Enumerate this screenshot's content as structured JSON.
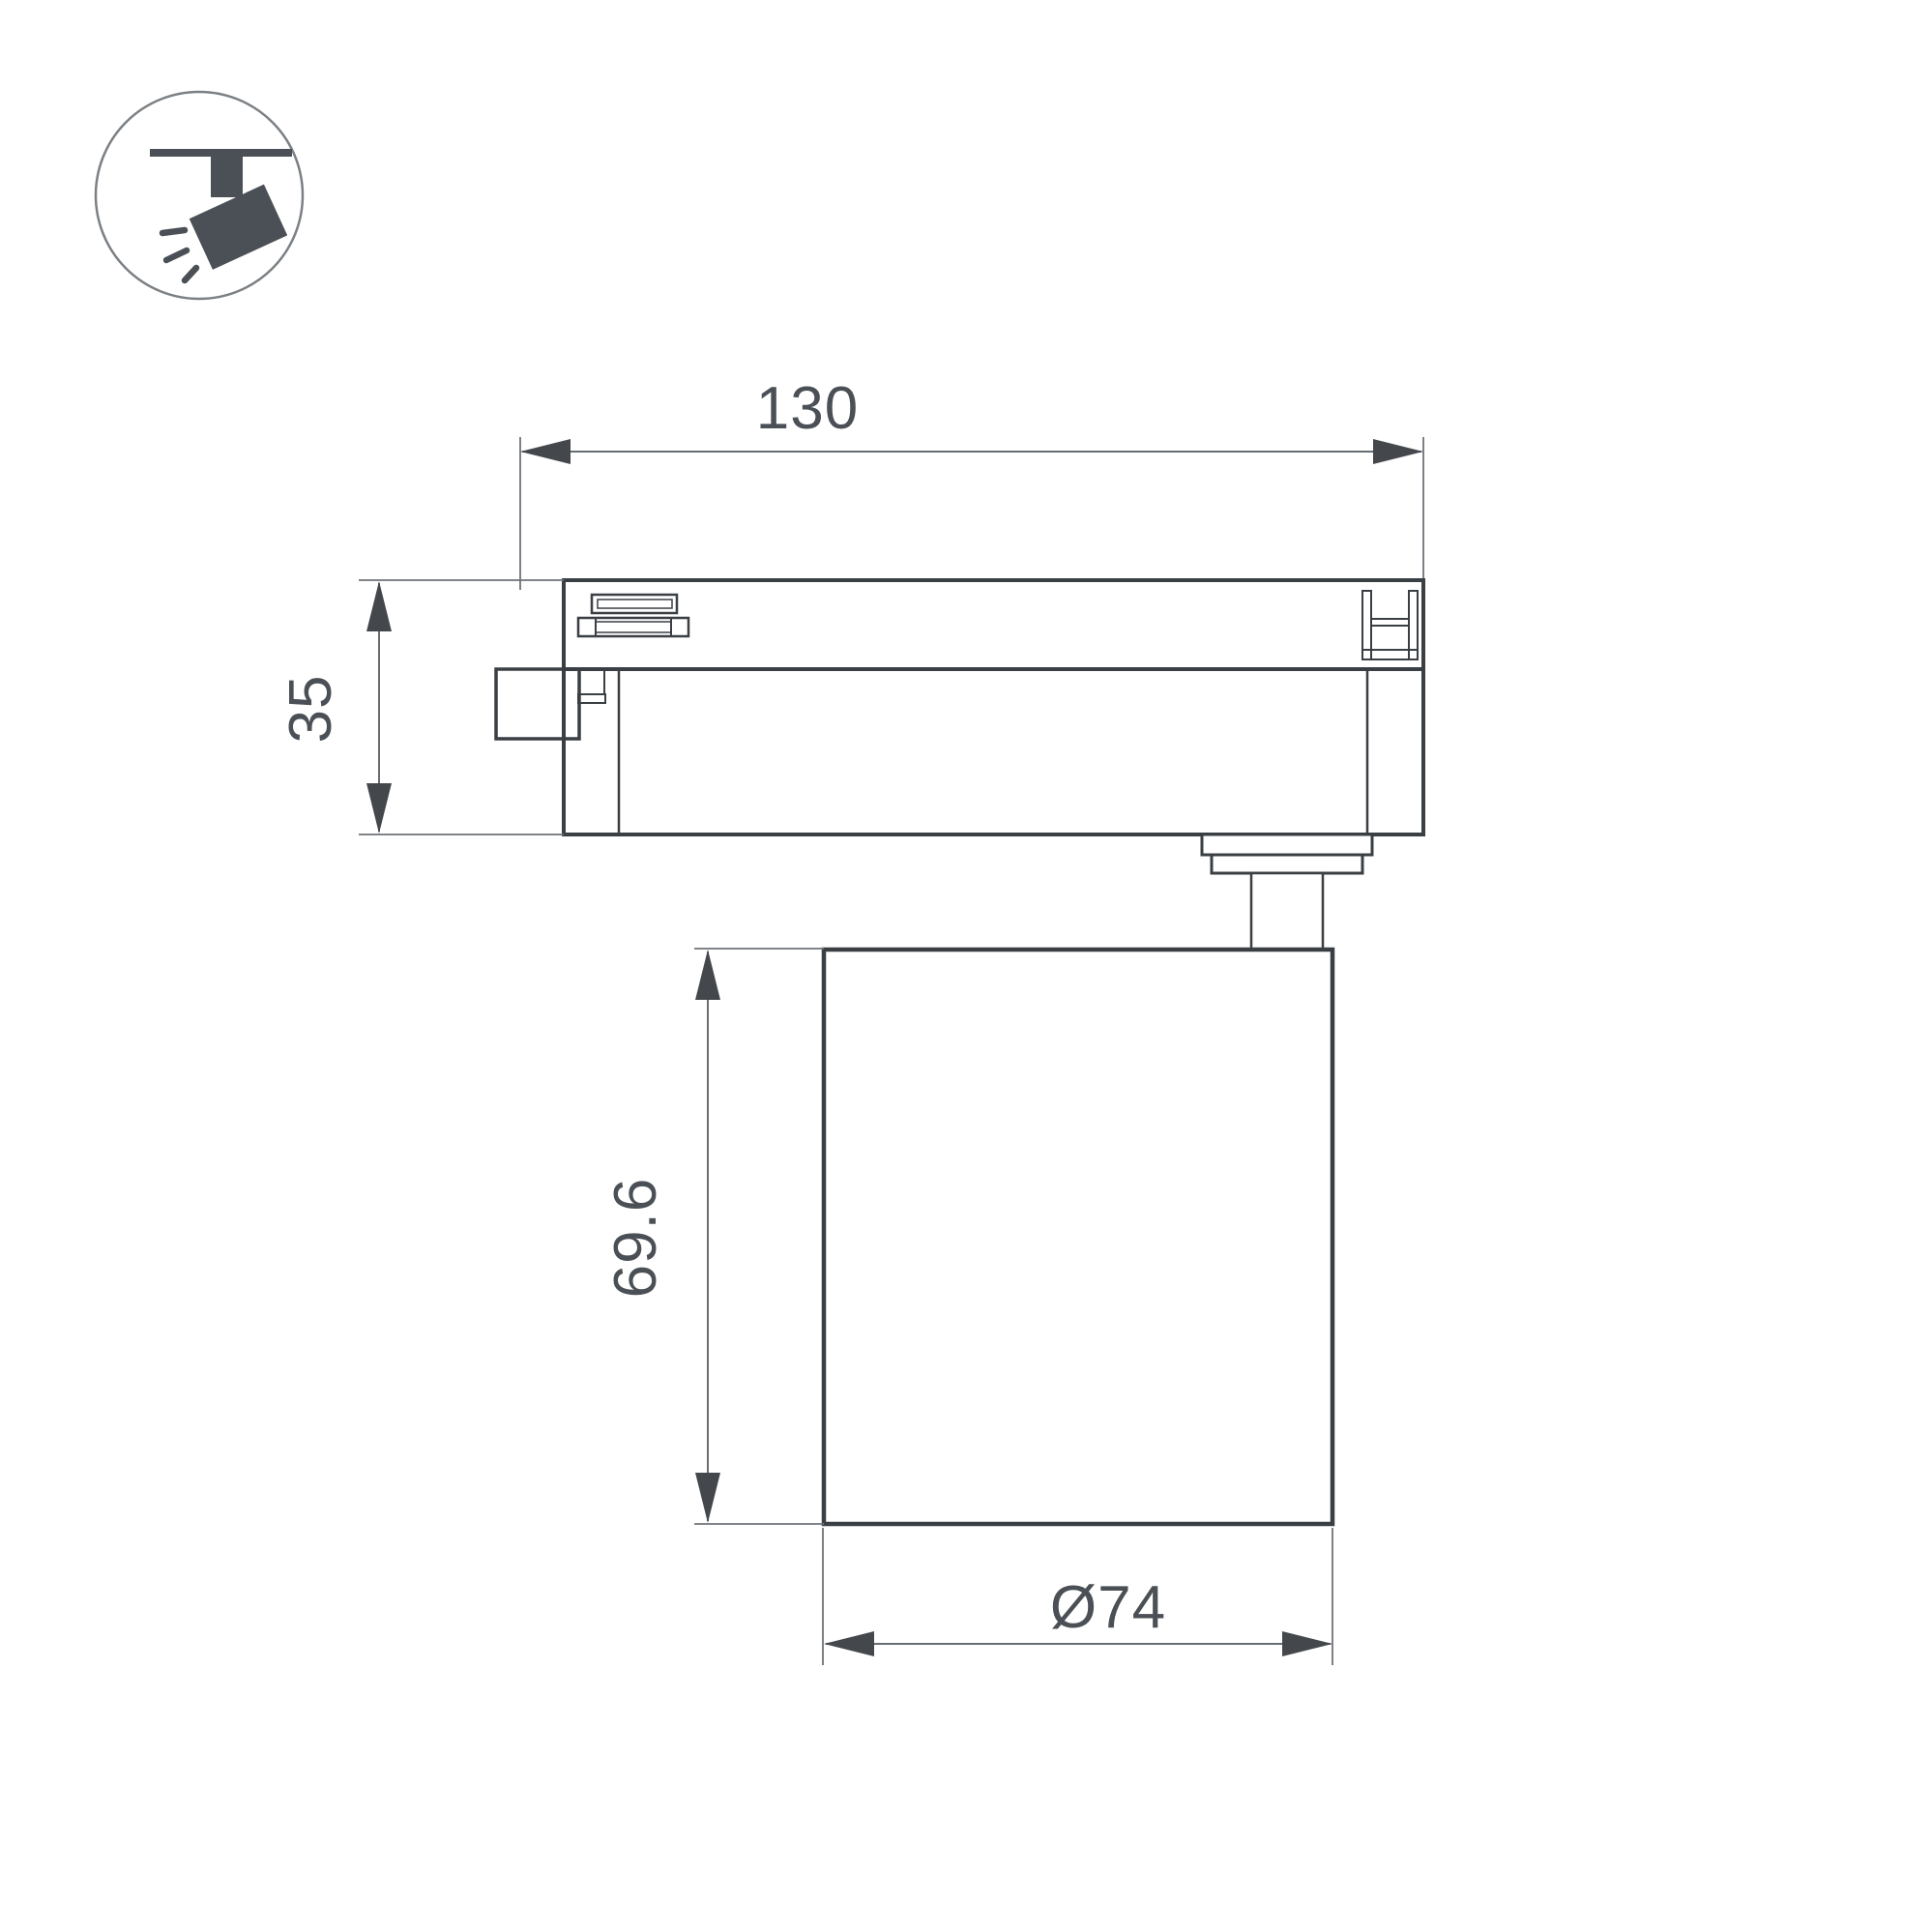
{
  "page": {
    "type": "technical-dimension-drawing",
    "background_color": "#ffffff",
    "line_color": "#3a3f44",
    "dimension_color": "#686d72",
    "text_color": "#4b5056",
    "icon_color": "#4a5056"
  },
  "icon": {
    "name": "track-spotlight-pictogram",
    "description": "ceiling track with tilted spotlight head emitting rays"
  },
  "drawing": {
    "view": "side view of track light fixture",
    "dimensions": {
      "track_adapter_length": {
        "label": "130"
      },
      "track_adapter_height": {
        "label": "35"
      },
      "lamp_body_height": {
        "label": "69.6"
      },
      "lamp_body_diameter": {
        "label": "Ø74"
      }
    }
  }
}
